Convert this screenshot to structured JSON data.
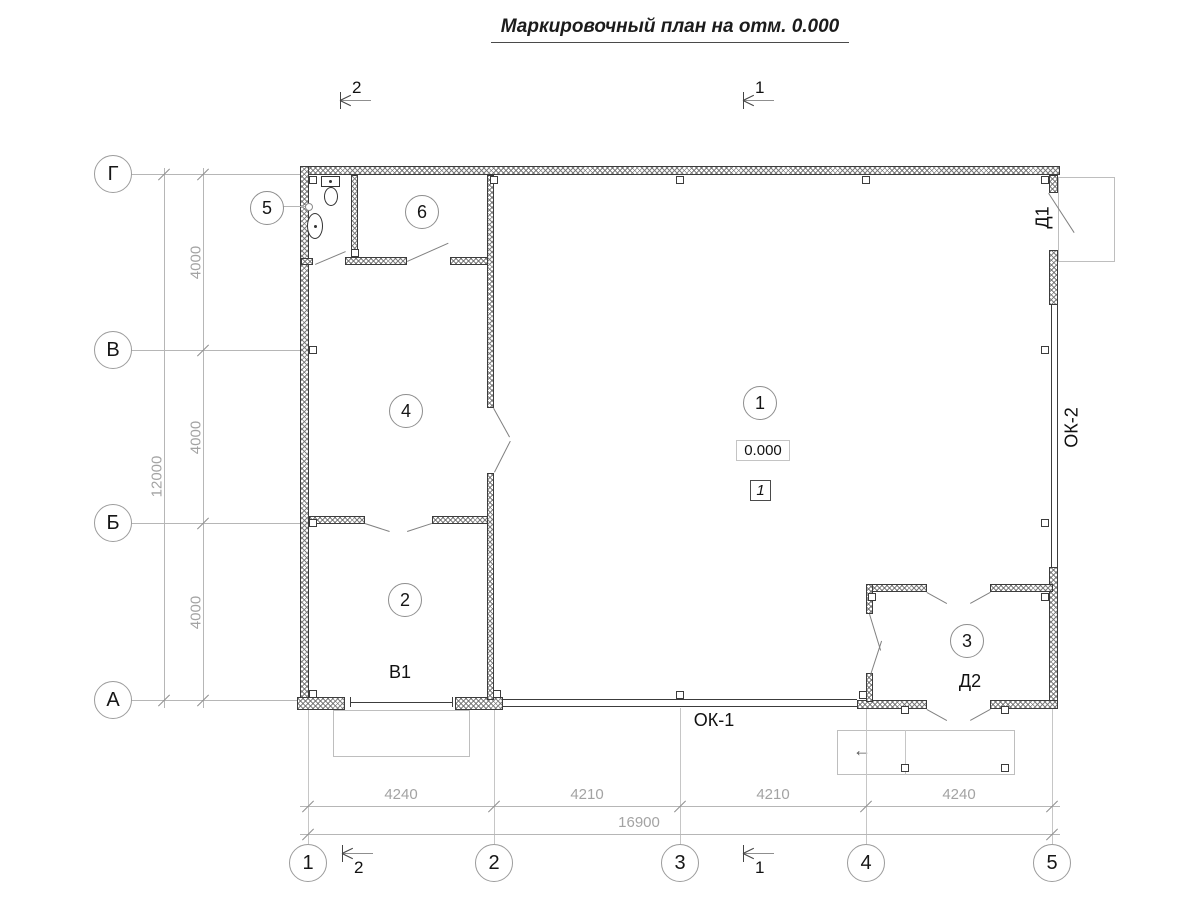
{
  "title": "Маркировочный план на отм. 0.000",
  "section_cuts": {
    "cut_1": "1",
    "cut_2": "2"
  },
  "axes_bottom": [
    "1",
    "2",
    "3",
    "4",
    "5"
  ],
  "axes_left": [
    "Г",
    "В",
    "Б",
    "А"
  ],
  "dimensions": {
    "bottom_segments": [
      "4240",
      "4210",
      "4210",
      "4240"
    ],
    "bottom_total": "16900",
    "left_segments": [
      "4000",
      "4000",
      "4000"
    ],
    "left_total": "12000"
  },
  "rooms": [
    {
      "number": "1"
    },
    {
      "number": "2"
    },
    {
      "number": "3"
    },
    {
      "number": "4"
    },
    {
      "number": "5"
    },
    {
      "number": "6"
    }
  ],
  "marks": {
    "elevation": "0.000",
    "floor_type": "1"
  },
  "labels": {
    "gate": "В1",
    "window_1": "ОК-1",
    "window_2": "ОК-2",
    "door_1": "Д1",
    "door_2": "Д2"
  },
  "icons": {
    "left_arrow": "←"
  }
}
